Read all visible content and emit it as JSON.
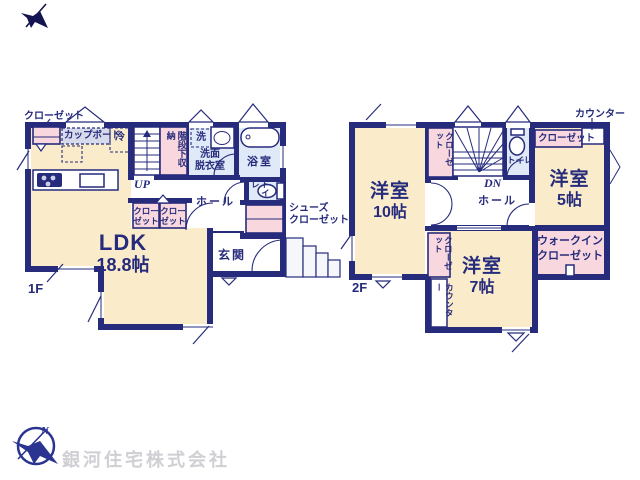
{
  "colors": {
    "wall_navy": "#262b7c",
    "room_cream": "#faeccb",
    "closet_pink": "#f8d8de",
    "wet_area_blue": "#dfe9f7",
    "counter_gray": "#d7daea",
    "logo_navy": "#2b3490",
    "company_text_gray": "#cfcfd4"
  },
  "company": {
    "name": "銀河住宅株式会社"
  },
  "floor1": {
    "floor_label": "1F",
    "ldk_name": "LDK",
    "ldk_size": "18.8帖",
    "closet_topleft": "クローゼット",
    "cupboard": "カップボード",
    "fridge": "冷",
    "stair_storage": "階段下収納",
    "up": "UP",
    "washer": "洗",
    "washroom": "洗面\n脱衣室",
    "bath": "浴室",
    "toilet": "トイレ",
    "hall": "ホール",
    "closet_a": "クロー\nゼット",
    "closet_b": "クロー\nゼット",
    "shoes_closet": "シューズ\nクローゼット",
    "entrance": "玄関"
  },
  "floor2": {
    "floor_label": "2F",
    "bedroom10_name": "洋室",
    "bedroom10_size": "10帖",
    "bedroom5_name": "洋室",
    "bedroom5_size": "5帖",
    "bedroom7_name": "洋室",
    "bedroom7_size": "7帖",
    "wic": "ウォークイン\nクローゼット",
    "hall": "ホール",
    "toilet": "トイレ",
    "dn": "DN",
    "counter_top": "カウンター",
    "counter_side": "カウンター",
    "closet_stairs": "クローゼット",
    "closet_bedroom5": "クローゼット",
    "closet_bedroom7": "クローゼット"
  }
}
